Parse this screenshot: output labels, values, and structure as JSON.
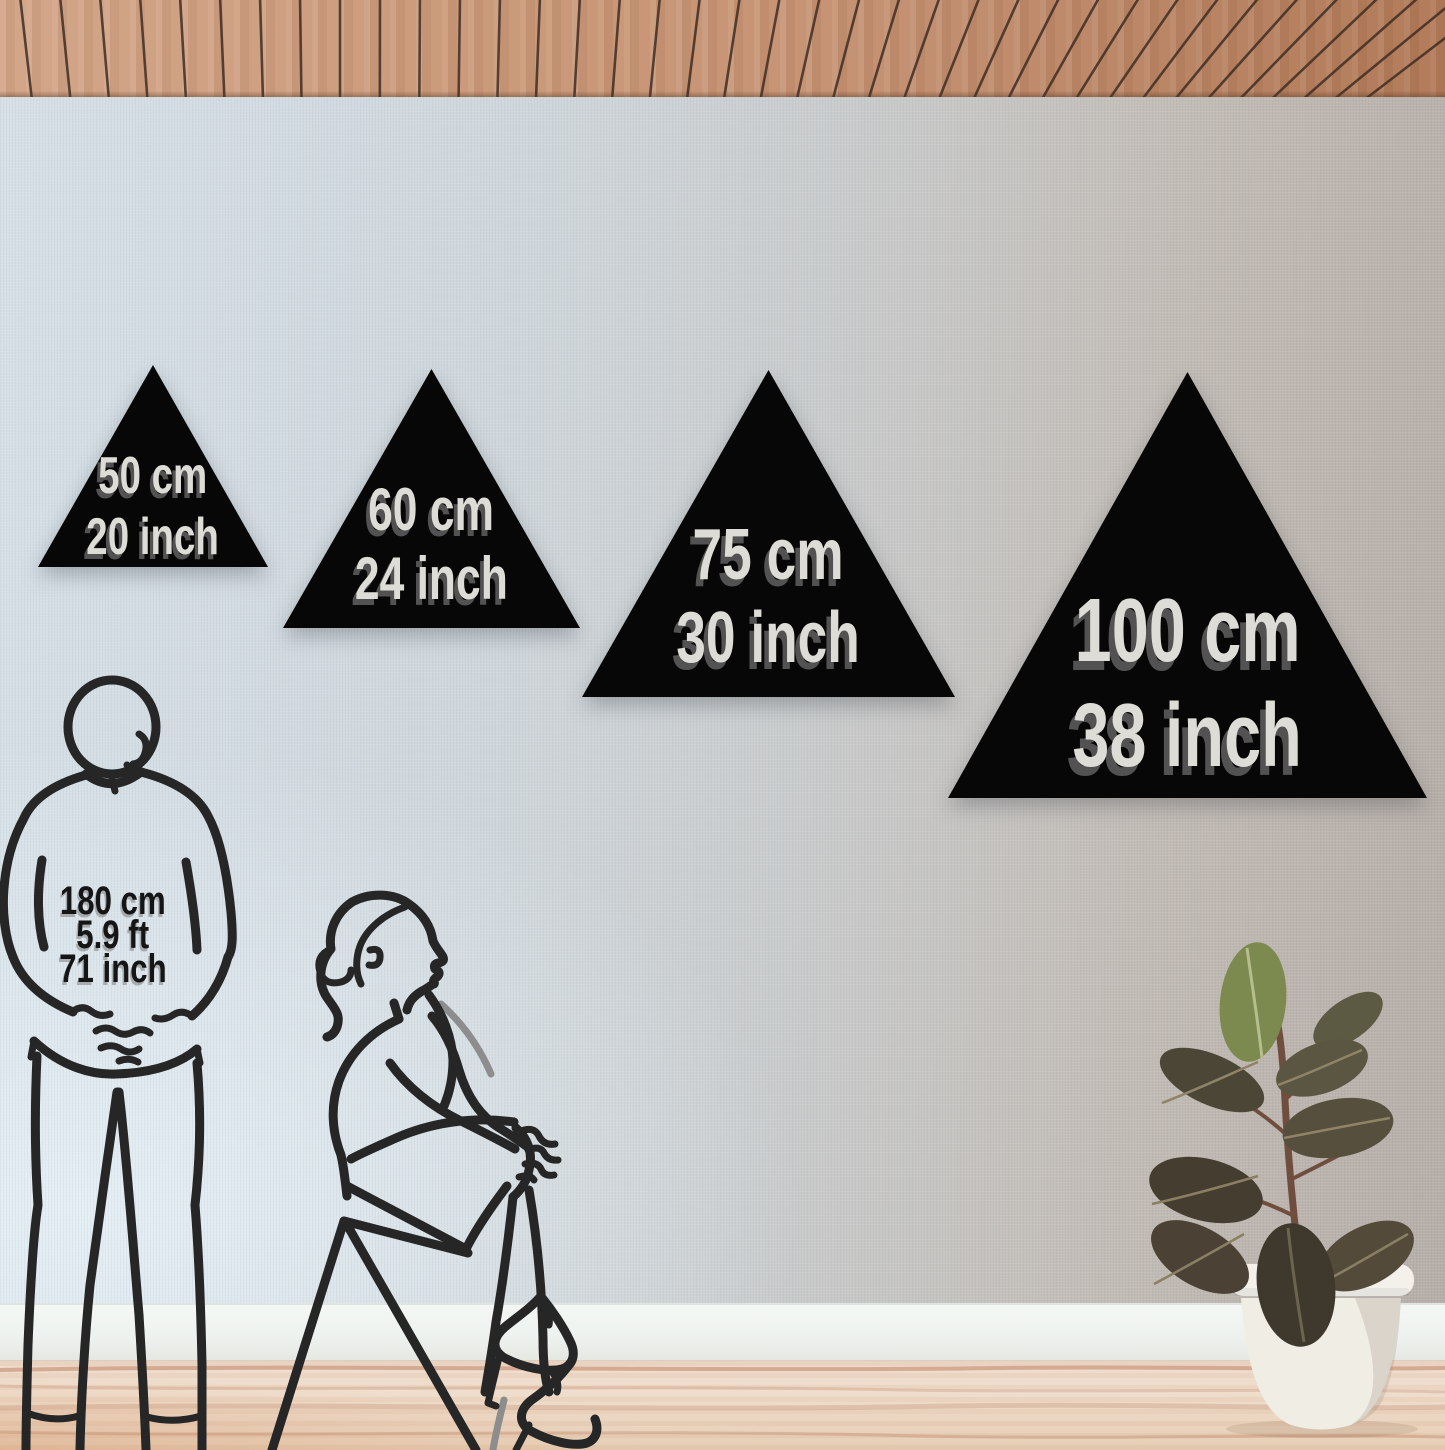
{
  "triangles": [
    {
      "cm_label": "50 cm",
      "inch_label": "20 inch"
    },
    {
      "cm_label": "60 cm",
      "inch_label": "24 inch"
    },
    {
      "cm_label": "75 cm",
      "inch_label": "30 inch"
    },
    {
      "cm_label": "100 cm",
      "inch_label": "38 inch"
    }
  ],
  "reference_person": {
    "height_cm": "180 cm",
    "height_ft": "5.9 ft",
    "height_inch": "71 inch"
  },
  "colors": {
    "triangle_fill": "#070707",
    "triangle_text": "#dedcd6",
    "line_art": "#262626",
    "person_label_text": "#151515"
  }
}
